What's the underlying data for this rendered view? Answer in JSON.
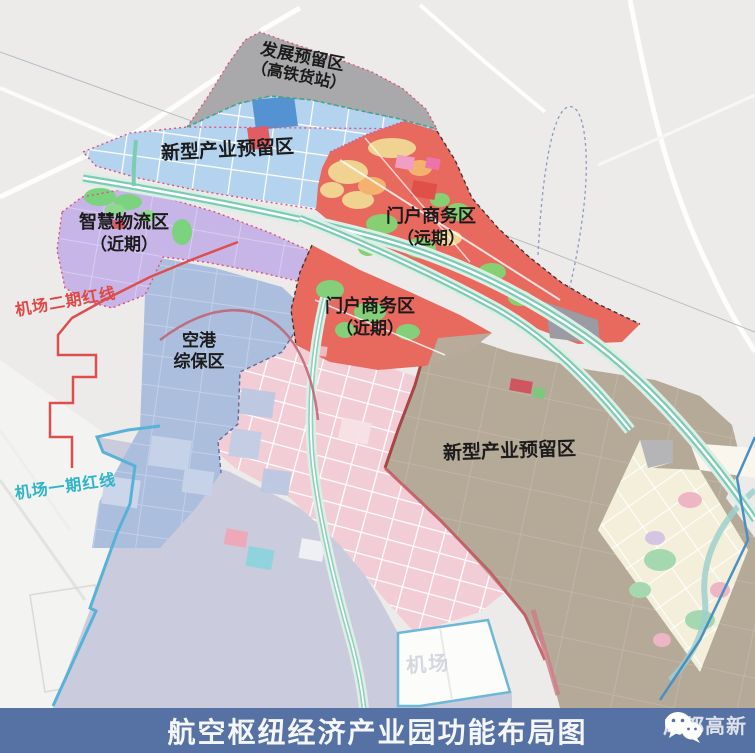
{
  "map": {
    "zones": [
      {
        "id": "dev-reserve",
        "label": "发展预留区",
        "sublabel": "（高铁货站）",
        "color": "#a9a9ab"
      },
      {
        "id": "new-industry-north",
        "label": "新型产业预留区",
        "color": "#b4d3ee"
      },
      {
        "id": "smart-logistics",
        "label": "智慧物流区",
        "sublabel": "（近期）",
        "color": "#c6b5e6"
      },
      {
        "id": "gateway-business-far",
        "label": "门户商务区",
        "sublabel": "（远期）",
        "color": "#e8695e"
      },
      {
        "id": "gateway-business-near",
        "label": "门户商务区",
        "sublabel": "（近期）",
        "color": "#e8695e"
      },
      {
        "id": "airport-bonded",
        "label_line1": "空港",
        "label_line2": "综保区",
        "color": "#abbedd"
      },
      {
        "id": "new-industry-south",
        "label": "新型产业预留区",
        "color": "#b5a998"
      }
    ],
    "boundary_lines": [
      {
        "id": "airport-phase2-redline",
        "label": "机场二期红线",
        "color": "#e04848"
      },
      {
        "id": "airport-phase1-redline",
        "label": "机场一期红线",
        "color": "#2fb5c8"
      }
    ],
    "watermark": "机场",
    "corridor_color": "#7cccb4",
    "background_color": "#ecebe9"
  },
  "banner": {
    "title": "航空枢纽经济产业园功能布局图",
    "brand": "成都高新",
    "background": "#5671a3",
    "icon": "wechat-logo-icon"
  }
}
